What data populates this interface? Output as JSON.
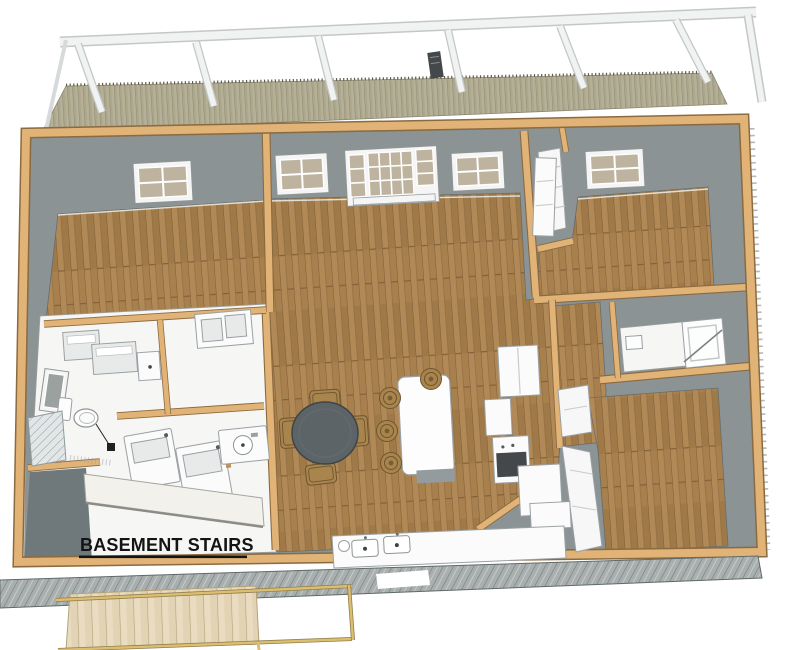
{
  "scene": {
    "type": "3d-floor-plan-render",
    "view": "overhead-isometric-dollhouse"
  },
  "labels": {
    "basement_stairs": "BASEMENT STAIRS"
  },
  "palette": {
    "background": "#ffffff",
    "wall-gray": "#8b9394",
    "void-gray": "#6f797b",
    "wood-frame": "#e2b377",
    "wood-frame-edge": "#8a6a40",
    "floor-wood": "#a8804e",
    "floor-white": "#f6f6f4",
    "deck-plank": "#b5b09a",
    "pergola-white": "#f1f2f2",
    "pergola-edge": "#c3c7c8",
    "cabinet-white": "#fbfbfb",
    "cabinet-edge": "#9aa0a3",
    "table-dark": "#5d6467",
    "wicker": "#a9854e",
    "wicker-edge": "#6e5430",
    "appliance-dark": "#44484a",
    "siding-gray": "#a9afae",
    "stair-plank": "#e9dcc1",
    "rail-tan": "#ddbd6e",
    "text-black": "#141414"
  }
}
